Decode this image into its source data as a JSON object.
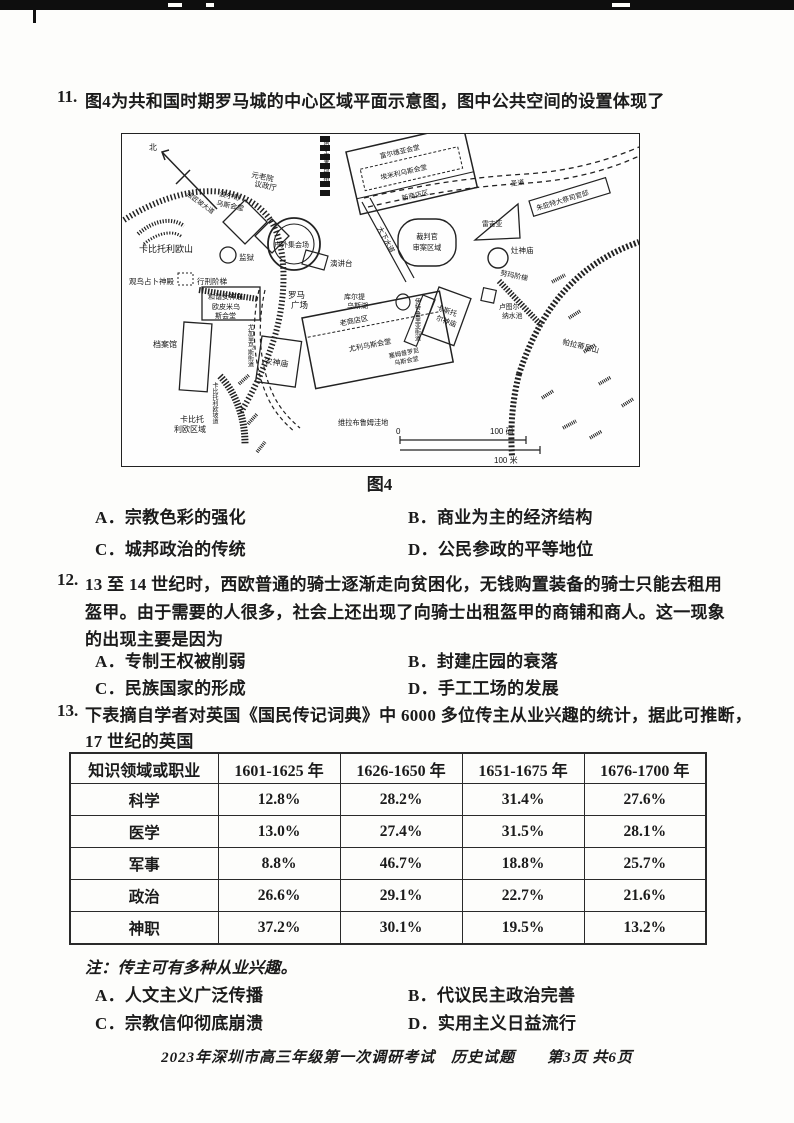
{
  "q11": {
    "number": "11.",
    "stem": "图4为共和国时期罗马城的中心区域平面示意图，图中公共空间的设置体现了",
    "caption": "图4",
    "opt_a": "A．宗教色彩的强化",
    "opt_b": "B．商业为主的经济结构",
    "opt_c": "C．城邦政治的传统",
    "opt_d": "D．公民参政的平等地位"
  },
  "map": {
    "north": "北",
    "hill": "卡比托利欧山",
    "silversmith_road": "银匠坡大道",
    "porcia_1": "波尔奇",
    "porcia_2": "乌斯会堂",
    "senate_1": "元老院",
    "senate_2": "议政厅",
    "assembly": "户外集会场",
    "rostra": "演讲台",
    "prison": "监狱",
    "augur_temple": "观鸟占卜神殿",
    "execution_stairs": "行刑阶梯",
    "concordia_1": "和谐女神庙",
    "concordia_2": "欧皮米乌",
    "concordia_3": "斯会堂",
    "archives": "档案馆",
    "forum_1": "罗马",
    "forum_2": "广场",
    "curtius_1": "库尔提",
    "curtius_2": "乌斯湖",
    "saturn": "农神庙",
    "capitoline_area_1": "卡比托",
    "capitoline_area_2": "利欧区域",
    "capitoline_slope": "卡比托利欧坡道",
    "jugarius_street": "尤加里乌斯街道",
    "old_shops": "老商店区",
    "basilica_julia": "尤利乌斯会堂",
    "sempronia_1": "塞姆普罗尼",
    "sempronia_2": "乌斯会堂",
    "velabrum": "维拉布鲁姆洼地",
    "tuscus_street": "伊特鲁里亚街道",
    "castor_1": "卡斯托",
    "castor_2": "尔神庙",
    "juturna_1": "卢图尔",
    "juturna_2": "纳水池",
    "vesta": "灶神庙",
    "numa_stairs": "努玛阶梯",
    "regia": "雷吉亚",
    "pontifex_house": "朱庇特大祭司官邸",
    "via_sacra": "圣道",
    "praetor_1": "裁判官",
    "praetor_2": "审案区域",
    "cloaca": "大下水道",
    "argiletum_street": "阿尔吉莱图姆街",
    "basilica_fulvia": "富尔维亚会堂",
    "basilica_aemilia": "埃米利乌斯会堂",
    "new_shops": "新商店区",
    "palatine": "帕拉蒂尼山",
    "scale_zero": "0",
    "scale_yd": "100 码",
    "scale_m": "100 米"
  },
  "q12": {
    "number": "12.",
    "line1": "13 至 14 世纪时，西欧普通的骑士逐渐走向贫困化，无钱购置装备的骑士只能去租用",
    "line2": "盔甲。由于需要的人很多，社会上还出现了向骑士出租盔甲的商铺和商人。这一现象",
    "line3": "的出现主要是因为",
    "opt_a": "A．专制王权被削弱",
    "opt_b": "B．封建庄园的衰落",
    "opt_c": "C．民族国家的形成",
    "opt_d": "D．手工工场的发展"
  },
  "q13": {
    "number": "13.",
    "line1": "下表摘自学者对英国《国民传记词典》中 6000 多位传主从业兴趣的统计，据此可推断，",
    "line2": "17 世纪的英国",
    "table": {
      "headers": [
        "知识领域或职业",
        "1601-1625 年",
        "1626-1650 年",
        "1651-1675 年",
        "1676-1700 年"
      ],
      "rows": [
        [
          "科学",
          "12.8%",
          "28.2%",
          "31.4%",
          "27.6%"
        ],
        [
          "医学",
          "13.0%",
          "27.4%",
          "31.5%",
          "28.1%"
        ],
        [
          "军事",
          "8.8%",
          "46.7%",
          "18.8%",
          "25.7%"
        ],
        [
          "政治",
          "26.6%",
          "29.1%",
          "22.7%",
          "21.6%"
        ],
        [
          "神职",
          "37.2%",
          "30.1%",
          "19.5%",
          "13.2%"
        ]
      ]
    },
    "note": "注：传主可有多种从业兴趣。",
    "opt_a": "A．人文主义广泛传播",
    "opt_b": "B．代议民主政治完善",
    "opt_c": "C．宗教信仰彻底崩溃",
    "opt_d": "D．实用主义日益流行"
  },
  "footer": "2023年深圳市高三年级第一次调研考试　历史试题　　第3页 共6页"
}
